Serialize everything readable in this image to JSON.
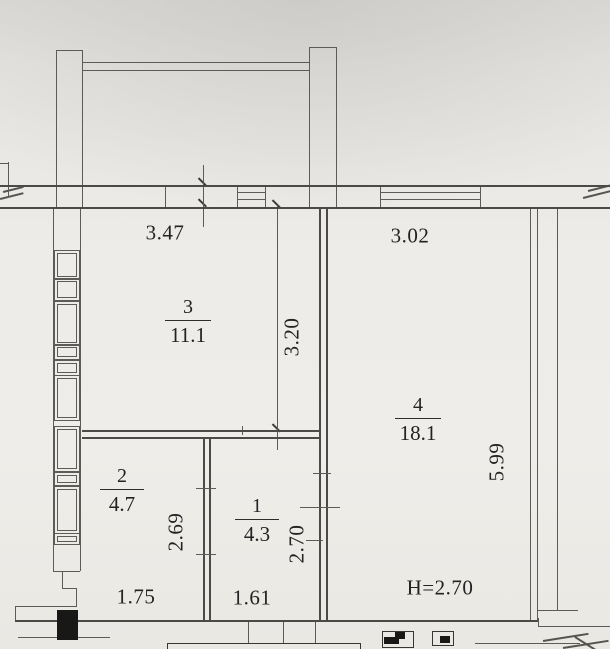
{
  "meta": {
    "drawing_type": "apartment floor plan (scanned)"
  },
  "colors": {
    "paper": "#eeece8",
    "line": "#5c5b58",
    "ink": "#232323"
  },
  "rooms": [
    {
      "number": "3",
      "area": "11.1"
    },
    {
      "number": "4",
      "area": "18.1"
    },
    {
      "number": "2",
      "area": "4.7"
    },
    {
      "number": "1",
      "area": "4.3"
    }
  ],
  "dimensions": {
    "top_left_width": "3.47",
    "top_right_width": "3.02",
    "room3_depth": "3.20",
    "room4_depth": "5.99",
    "room2_depth": "2.69",
    "room1_depth": "2.70",
    "bottom_left_width": "1.75",
    "bottom_mid_width": "1.61",
    "ceiling_height": "H=2.70"
  }
}
